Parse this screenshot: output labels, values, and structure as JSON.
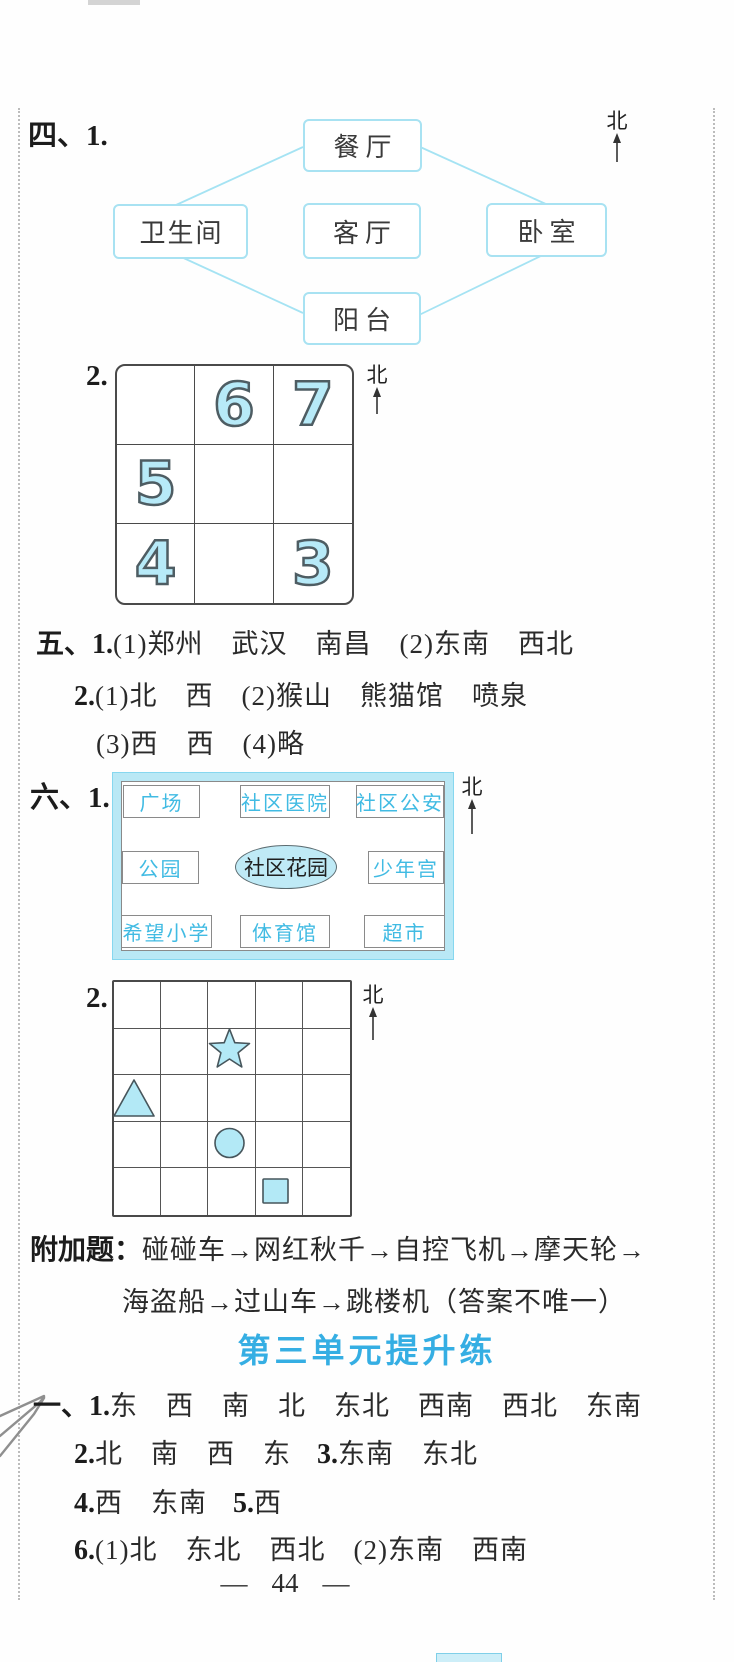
{
  "compass": {
    "north_label": "北"
  },
  "section_four": {
    "label": "四、1.",
    "rooms": {
      "top": "餐厅",
      "left": "卫生间",
      "center": "客厅",
      "right": "卧室",
      "bottom": "阳台"
    },
    "item2": {
      "label": "2.",
      "grid_cells": [
        "",
        "6",
        "7",
        "5",
        "",
        "",
        "4",
        "",
        "3"
      ]
    }
  },
  "section_five": {
    "line1": {
      "label": "五、1.",
      "text": "(1)郑州　武汉　南昌　(2)东南　西北"
    },
    "line2": {
      "label": "2.",
      "text": "(1)北　西　(2)猴山　熊猫馆　喷泉"
    },
    "line3": {
      "text": "(3)西　西　(4)略"
    }
  },
  "section_six": {
    "label": "六、1.",
    "map": {
      "places": [
        "广场",
        "社区医院",
        "社区公安",
        "公园",
        "社区花园",
        "少年宫",
        "希望小学",
        "体育馆",
        "超市"
      ]
    },
    "item2": {
      "label": "2.",
      "shapes": [
        "star",
        "triangle",
        "circle",
        "square"
      ]
    }
  },
  "bonus": {
    "label": "附加题：",
    "line1": "碰碰车→网红秋千→自控飞机→摩天轮→",
    "line2": "海盗船→过山车→跳楼机（答案不唯一）"
  },
  "unit3": {
    "heading": "第三单元提升练",
    "line1": {
      "label": "一、1.",
      "text": "东　西　南　北　东北　西南　西北　东南"
    },
    "line2": {
      "label_a": "2.",
      "text_a": "北　南　西　东",
      "label_b": "3.",
      "text_b": "东南　东北"
    },
    "line3": {
      "label_a": "4.",
      "text_a": "西　东南",
      "label_b": "5.",
      "text_b": "西"
    },
    "line4": {
      "label": "6.",
      "text": "(1)北　东北　西北　(2)东南　西南"
    }
  },
  "page": {
    "footer": {
      "left_dash": "—",
      "page_number": "44",
      "right_dash": "—"
    }
  },
  "colors": {
    "accent_cyan": "#35aee3",
    "diagram_line": "#a5e3f3",
    "bubble_fill": "#b7eaf8",
    "shape_fill": "#b3e9f6",
    "map_frame": "#b9e8f5"
  }
}
